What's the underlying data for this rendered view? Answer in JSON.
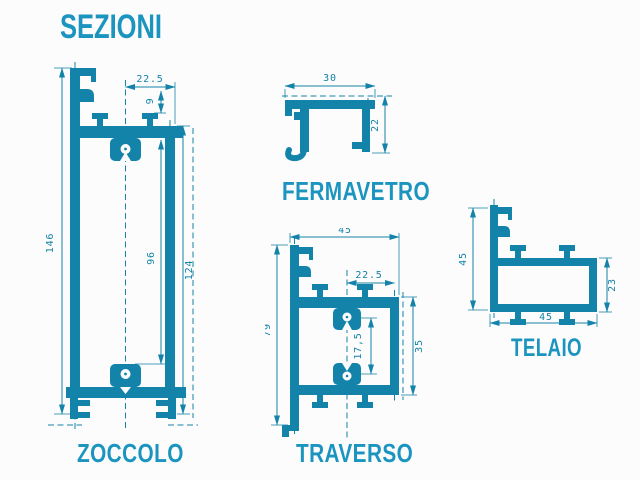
{
  "title": "SEZIONI",
  "colors": {
    "accent": "#1b95c0",
    "line": "#1483a9",
    "background": "#fcfcfc"
  },
  "sections": [
    {
      "id": "zoccolo",
      "label": "ZOCCOLO",
      "dims": {
        "total_height": "146",
        "half_width": "22.5",
        "tab": "9",
        "inner": "96",
        "right": "124"
      }
    },
    {
      "id": "fermavetro",
      "label": "FERMAVETRO",
      "dims": {
        "width": "30",
        "height": "22"
      }
    },
    {
      "id": "traverso",
      "label": "TRAVERSO",
      "dims": {
        "width": "45",
        "half_width": "22.5",
        "clip_gap": "17,5",
        "chamber": "35",
        "height": "79"
      }
    },
    {
      "id": "telaio",
      "label": "TELAIO",
      "dims": {
        "left_height": "45",
        "right_height": "23",
        "width": "45"
      }
    }
  ]
}
